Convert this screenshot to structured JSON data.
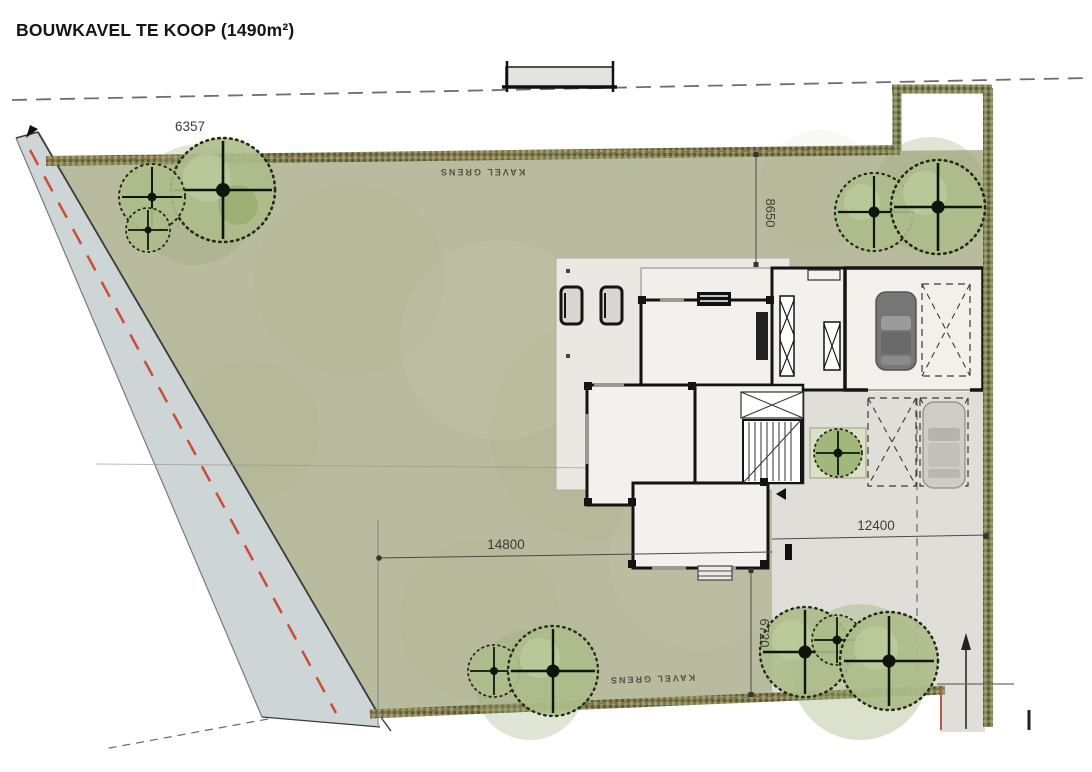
{
  "title": "BOUWKAVEL TE KOOP (1490m²)",
  "boundary_labels": {
    "top": "KAVEL GRENS",
    "bottom": "KAVEL GRENS"
  },
  "dimensions": {
    "top_edge": "6357",
    "north_garden_depth": "8650",
    "garden_width": "14800",
    "driveway_width": "12400",
    "south_garden_depth": "6720"
  },
  "colors": {
    "plot_green": "#b9bb9e",
    "hedge_olive": "#83855a",
    "road_gray_blue": "#ced5d7",
    "boundary_red": "#c94e38",
    "driveway_gray": "#e0ded8",
    "terrace_gray": "#eae8e2",
    "house_fill": "#f2f1ed",
    "wall_black": "#141414",
    "tree_green": "#adbc8a"
  }
}
